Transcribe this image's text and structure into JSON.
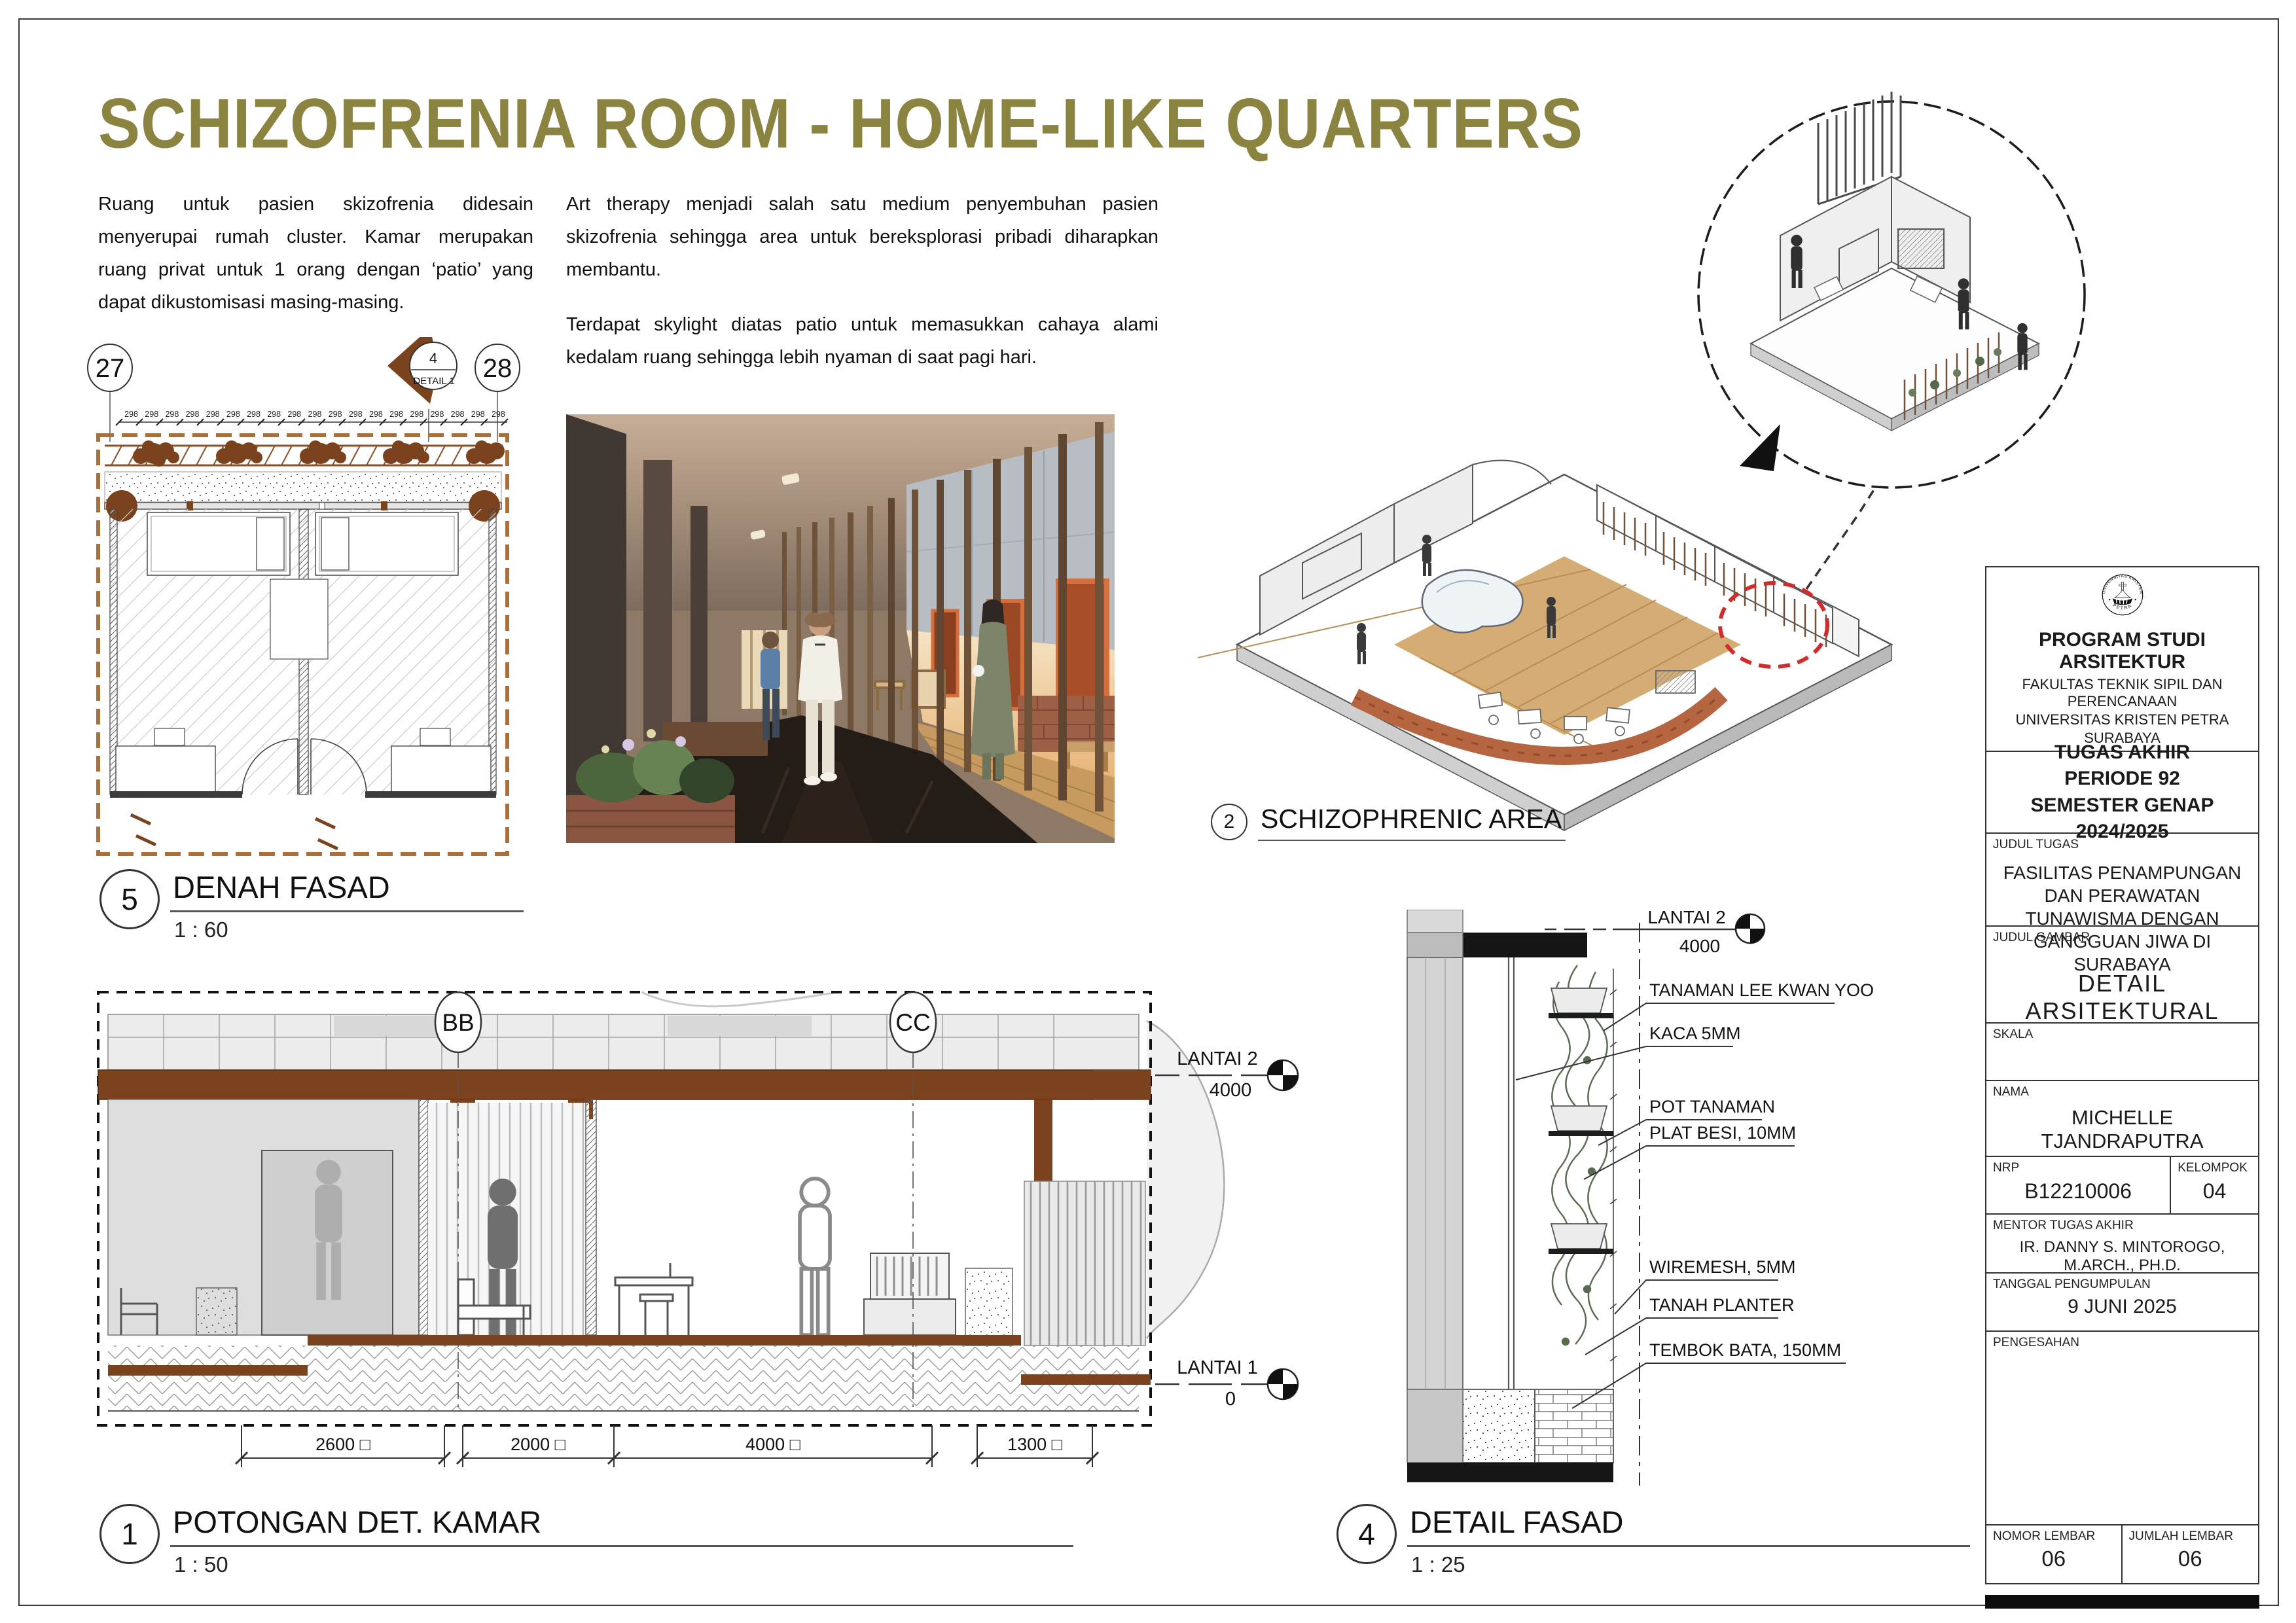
{
  "title": "SCHIZOFRENIA ROOM - HOME-LIKE QUARTERS",
  "intro": {
    "para1": "Ruang untuk pasien skizofrenia didesain menyerupai rumah cluster. Kamar merupakan ruang privat untuk 1 orang dengan ‘patio’ yang dapat dikustomisasi masing-masing.",
    "para2": "Art therapy menjadi salah satu medium penyembuhan pasien skizofrenia sehingga area untuk bereksplorasi pribadi diharapkan membantu.",
    "para3": "Terdapat skylight diatas patio untuk memasukkan cahaya alami kedalam ruang sehingga lebih nyaman di saat pagi hari."
  },
  "plan": {
    "grid_left": "27",
    "grid_right": "28",
    "detail_marker_number": "4",
    "detail_marker_label": "DETAIL 1",
    "top_dims": [
      "298",
      "298",
      "298",
      "298",
      "298",
      "298",
      "298",
      "298",
      "298",
      "298",
      "298",
      "298",
      "298",
      "298",
      "298",
      "298",
      "298",
      "298",
      "298"
    ],
    "title_number": "5",
    "title_label": "DENAH FASAD",
    "title_scale": "1 : 60"
  },
  "axon": {
    "title_number": "2",
    "title_label": "SCHIZOPHRENIC AREA"
  },
  "section": {
    "marker_bb": "BB",
    "marker_cc": "CC",
    "level2_name": "LANTAI 2",
    "level2_value": "4000",
    "level1_name": "LANTAI 1",
    "level1_value": "0",
    "dims": [
      "2600 □",
      "2000 □",
      "4000 □",
      "1300 □"
    ],
    "title_number": "1",
    "title_label": "POTONGAN DET. KAMAR",
    "title_scale": "1 : 50"
  },
  "detail": {
    "level_name": "LANTAI 2",
    "level_value": "4000",
    "callouts": [
      "TANAMAN LEE KWAN YOO",
      "KACA 5MM",
      "POT TANAMAN",
      "PLAT BESI, 10MM",
      "WIREMESH, 5MM",
      "TANAH PLANTER",
      "TEMBOK BATA, 150MM"
    ],
    "title_number": "4",
    "title_label": "DETAIL FASAD",
    "title_scale": "1 : 25"
  },
  "titleblock": {
    "logo_top": "UNIVERSITAS KRISTEN",
    "logo_bottom": "PETRA",
    "program": "PROGRAM STUDI ARSITEKTUR",
    "faculty": "FAKULTAS TEKNIK SIPIL DAN PERENCANAAN",
    "university": "UNIVERSITAS KRISTEN PETRA",
    "city": "SURABAYA",
    "assignment_line1": "TUGAS AKHIR",
    "assignment_line2": "PERIODE 92",
    "assignment_line3": "SEMESTER GENAP 2024/2025",
    "label_judul_tugas": "JUDUL TUGAS",
    "judul_tugas": "FASILITAS PENAMPUNGAN DAN PERAWATAN TUNAWISMA DENGAN GANGGUAN JIWA DI SURABAYA",
    "label_judul_gambar": "JUDUL GAMBAR",
    "judul_gambar": "DETAIL  ARSITEKTURAL",
    "label_skala": "SKALA",
    "label_nama": "NAMA",
    "nama": "MICHELLE TJANDRAPUTRA",
    "label_nrp": "NRP",
    "nrp": "B12210006",
    "label_kelompok": "KELOMPOK",
    "kelompok": "04",
    "label_mentor": "MENTOR TUGAS AKHIR",
    "mentor": "IR. DANNY S. MINTOROGO, M.ARCH., PH.D.",
    "label_tanggal": "TANGGAL PENGUMPULAN",
    "tanggal": "9 JUNI 2025",
    "label_pengesahan": "PENGESAHAN",
    "label_nomor": "NOMOR LEMBAR",
    "nomor": "06",
    "label_jumlah": "JUMLAH LEMBAR",
    "jumlah": "06"
  },
  "colors": {
    "accent_olive": "#8b8441",
    "drawing_brown": "#7a431d",
    "dash_terracotta": "#a9703d",
    "highlight_red": "#d02c2c"
  }
}
